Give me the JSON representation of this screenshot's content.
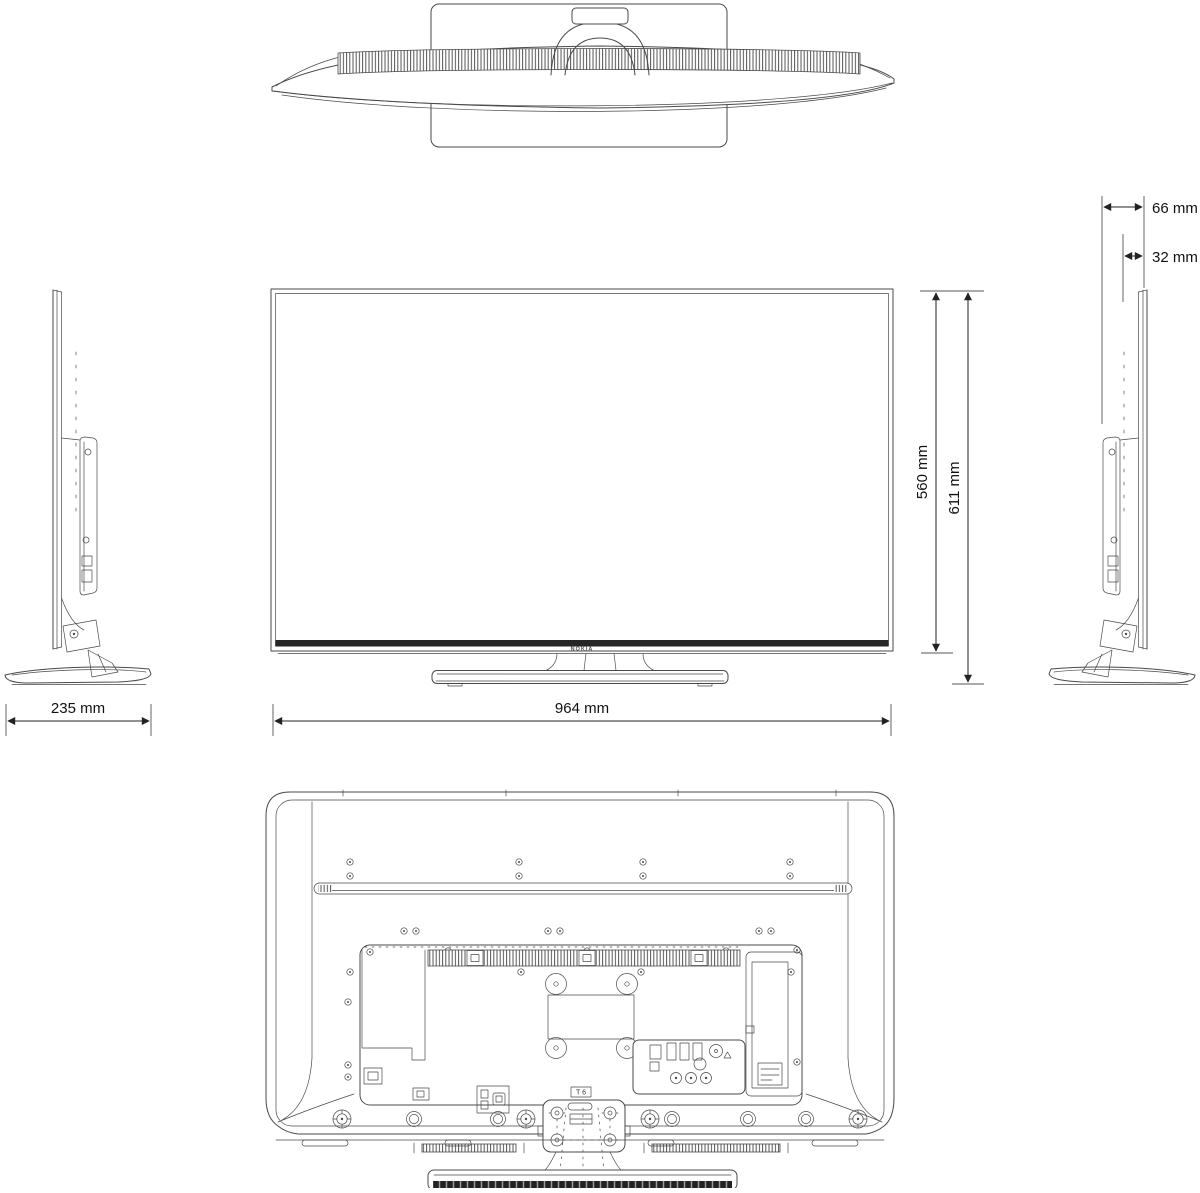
{
  "drawing": {
    "brand_logo": "NOKIA",
    "stand_mount_screw_label": "T 6",
    "dimensions": {
      "depth_total": "66 mm",
      "depth_panel": "32 mm",
      "height_without_stand": "560 mm",
      "height_with_stand": "611 mm",
      "stand_base_depth": "235 mm",
      "width": "964 mm"
    },
    "colors": {
      "line": "#4a4a4a",
      "bezel_strip": "#262626",
      "dimension_text": "#111111",
      "background": "#ffffff"
    }
  }
}
